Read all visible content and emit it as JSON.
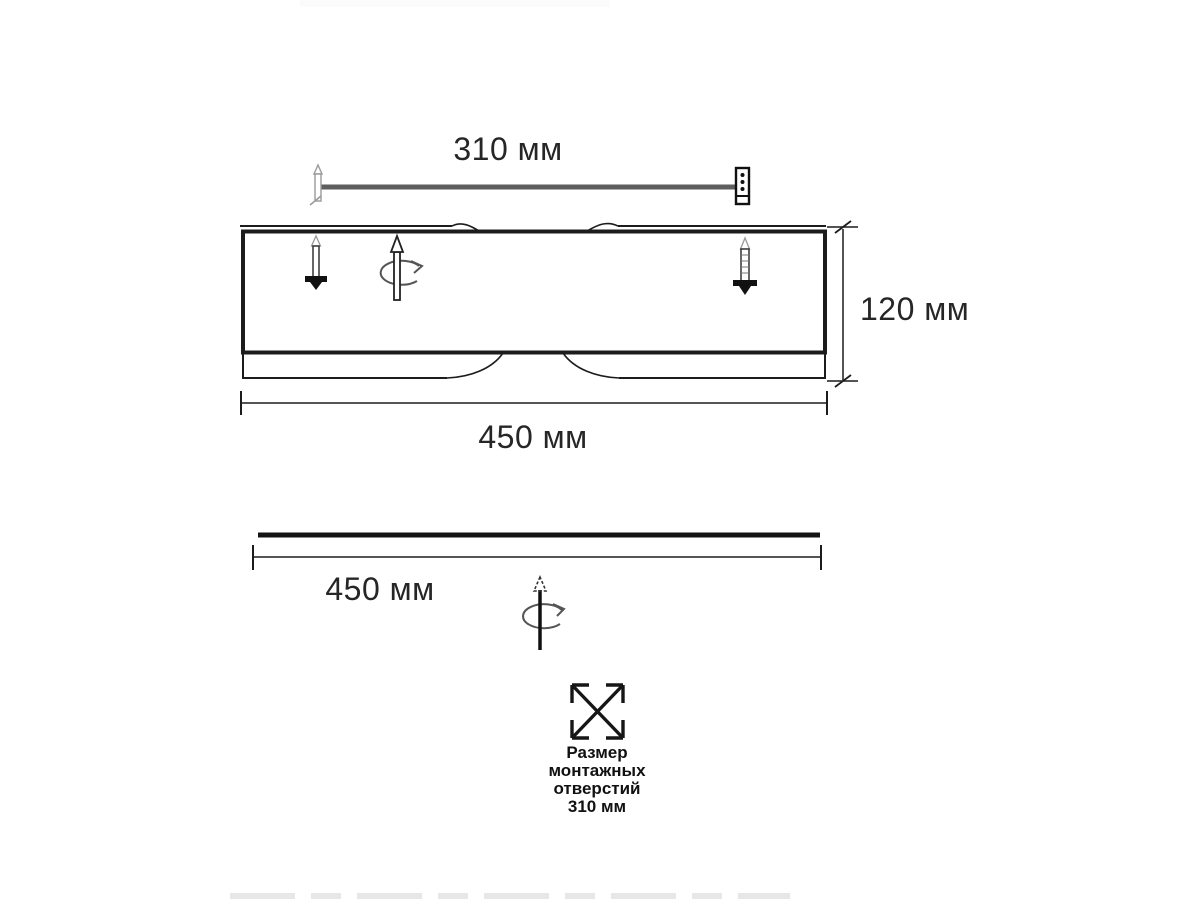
{
  "drawing": {
    "top_dimension_label": "310 мм",
    "height_dimension_label": "120 мм",
    "front_width_dimension_label": "450 мм",
    "side_width_dimension_label": "450 мм",
    "mounting_note_line1": "Размер",
    "mounting_note_line2": "монтажных",
    "mounting_note_line3": "отверстий",
    "mounting_note_line4": "310 мм",
    "colors": {
      "line": "#1c1c1c",
      "bar": "#5e5e5e",
      "text": "#262626"
    },
    "icons": {
      "top_left_fastener": "screw-icon",
      "top_right_fastener": "wall-anchor-icon",
      "body_left_fastener": "screw-down-icon",
      "body_right_fastener": "threaded-screw-icon",
      "body_rotation": "rotate-arrow-icon",
      "side_rotation": "rotate-arrow-icon",
      "mounting_holes": "crossed-square-icon"
    }
  }
}
